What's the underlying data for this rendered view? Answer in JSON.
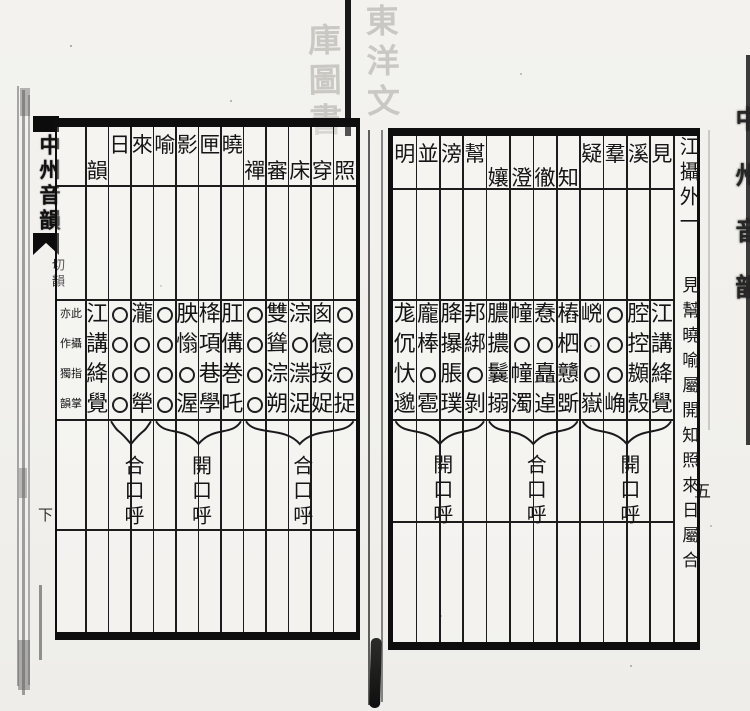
{
  "book_title": "中州音韻",
  "seal": {
    "description": "faint library seal, seal-script",
    "columns": [
      "東洋文",
      "庫圖書"
    ]
  },
  "left_fold": {
    "title": "中州音韻",
    "section": "切韻",
    "volume": "下"
  },
  "right_fold": {
    "title": "中州音韻",
    "page_number": "五"
  },
  "tone_rows": [
    "平",
    "上",
    "去",
    "入"
  ],
  "right_page": {
    "columns": [
      {
        "header": "明",
        "header_row": 1,
        "cells": [
          "尨",
          "伔",
          "忕",
          "邈"
        ]
      },
      {
        "header": "並",
        "header_row": 1,
        "cells": [
          "龐",
          "棒",
          "○",
          "雹"
        ]
      },
      {
        "header": "滂",
        "header_row": 1,
        "cells": [
          "胮",
          "㩧",
          "脹",
          "璞"
        ]
      },
      {
        "header": "幫",
        "header_row": 1,
        "cells": [
          "邦",
          "綁",
          "○",
          "剝"
        ]
      },
      {
        "header": "孃",
        "header_row": 2,
        "cells": [
          "膿",
          "擃",
          "鬤",
          "搦"
        ]
      },
      {
        "header": "澄",
        "header_row": 2,
        "cells": [
          "幢",
          "○",
          "幢",
          "濁"
        ]
      },
      {
        "header": "徹",
        "header_row": 2,
        "cells": [
          "憃",
          "○",
          "矗",
          "逴"
        ]
      },
      {
        "header": "知",
        "header_row": 2,
        "cells": [
          "樁",
          "柶",
          "戇",
          "斲"
        ]
      },
      {
        "header": "疑",
        "header_row": 1,
        "cells": [
          "㟅",
          "○",
          "○",
          "嶽"
        ]
      },
      {
        "header": "羣",
        "header_row": 1,
        "cells": [
          "○",
          "○",
          "○",
          "崅"
        ]
      },
      {
        "header": "溪",
        "header_row": 1,
        "cells": [
          "腔",
          "控",
          "䫨",
          "殼"
        ]
      },
      {
        "header": "見",
        "header_row": 1,
        "cells": [
          "江",
          "講",
          "絳",
          "覺"
        ]
      },
      {
        "header": "江攝外一",
        "type": "heading",
        "annotation": "見幫曉喻屬開知照來日屬合"
      }
    ],
    "brackets": [
      {
        "from": 0,
        "to": 3,
        "label": "開口呼"
      },
      {
        "from": 4,
        "to": 7,
        "label": "合口呼"
      },
      {
        "from": 8,
        "to": 11,
        "label": "開口呼"
      }
    ]
  },
  "left_page": {
    "columns": [
      {
        "header": "",
        "type": "note",
        "note_right": "此攝指掌",
        "note_left": "亦作獨韻"
      },
      {
        "header": "韻",
        "header_row": 2,
        "cells": [
          "江",
          "講",
          "絳",
          "覺"
        ]
      },
      {
        "header": "日",
        "header_row": 1,
        "cells": [
          "○",
          "○",
          "○",
          "○"
        ]
      },
      {
        "header": "來",
        "header_row": 1,
        "cells": [
          "瀧",
          "○",
          "○",
          "犖"
        ]
      },
      {
        "header": "喻",
        "header_row": 1,
        "cells": [
          "○",
          "○",
          "○",
          "○"
        ]
      },
      {
        "header": "影",
        "header_row": 1,
        "cells": [
          "胦",
          "慃",
          "○",
          "渥"
        ]
      },
      {
        "header": "匣",
        "header_row": 1,
        "cells": [
          "栙",
          "項",
          "巷",
          "學"
        ]
      },
      {
        "header": "曉",
        "header_row": 1,
        "cells": [
          "肛",
          "傋",
          "巻",
          "吒"
        ]
      },
      {
        "header": "禪",
        "header_row": 2,
        "cells": [
          "○",
          "○",
          "○",
          "○"
        ]
      },
      {
        "header": "審",
        "header_row": 2,
        "cells": [
          "雙",
          "聳",
          "淙",
          "朔"
        ]
      },
      {
        "header": "床",
        "header_row": 2,
        "cells": [
          "淙",
          "○",
          "漴",
          "浞"
        ]
      },
      {
        "header": "穿",
        "header_row": 2,
        "cells": [
          "囪",
          "億",
          "挼",
          "娖"
        ]
      },
      {
        "header": "照",
        "header_row": 2,
        "cells": [
          "○",
          "○",
          "○",
          "捉"
        ]
      }
    ],
    "brackets": [
      {
        "from": 2,
        "to": 3,
        "label": "合口呼"
      },
      {
        "from": 4,
        "to": 7,
        "label": "開口呼"
      },
      {
        "from": 8,
        "to": 12,
        "label": "合口呼"
      }
    ]
  }
}
